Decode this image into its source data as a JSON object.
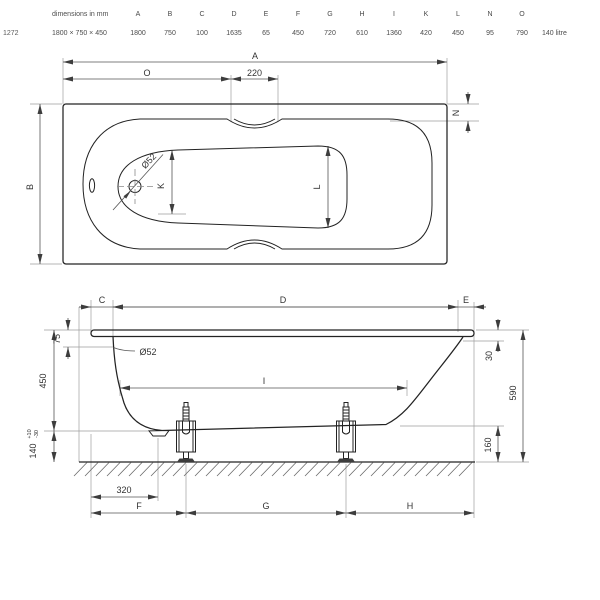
{
  "table": {
    "title": "dimensions in mm",
    "model": "1272",
    "size": "1800 × 750 × 450",
    "capacity": "140 litre",
    "cols": [
      {
        "letter": "A",
        "value": "1800"
      },
      {
        "letter": "B",
        "value": "750"
      },
      {
        "letter": "C",
        "value": "100"
      },
      {
        "letter": "D",
        "value": "1635"
      },
      {
        "letter": "E",
        "value": "65"
      },
      {
        "letter": "F",
        "value": "450"
      },
      {
        "letter": "G",
        "value": "720"
      },
      {
        "letter": "H",
        "value": "610"
      },
      {
        "letter": "I",
        "value": "1360"
      },
      {
        "letter": "K",
        "value": "420"
      },
      {
        "letter": "L",
        "value": "450"
      },
      {
        "letter": "N",
        "value": "95"
      },
      {
        "letter": "O",
        "value": "790"
      }
    ]
  },
  "top_view": {
    "a": "A",
    "o": "O",
    "d220": "220",
    "b": "B",
    "n": "N",
    "k": "K",
    "l": "L",
    "drain_label": "Ø52"
  },
  "side_view": {
    "c": "C",
    "d": "D",
    "e": "E",
    "i": "I",
    "f": "F",
    "g": "G",
    "h": "H",
    "v75": "75",
    "v450": "450",
    "v140": "140",
    "tol_plus": "+10",
    "tol_minus": "-30",
    "v30": "30",
    "v590": "590",
    "v160": "160",
    "v320": "320",
    "overflow_label": "Ø52"
  }
}
